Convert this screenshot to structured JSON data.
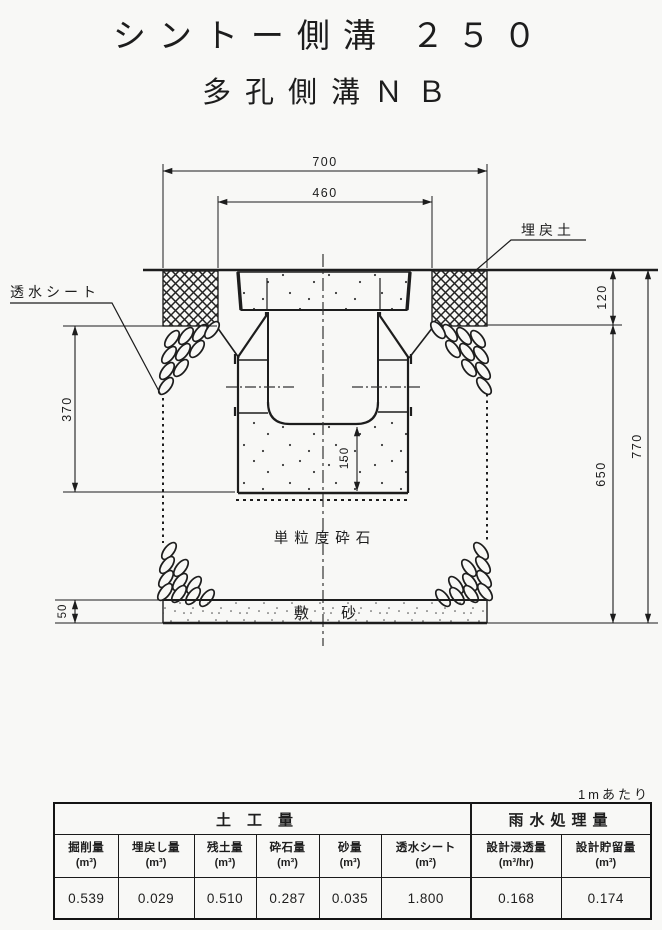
{
  "page": {
    "title": "シントー側溝 ２５０",
    "subtitle": "多孔側溝ＮＢ"
  },
  "drawing": {
    "labels": {
      "backfill_soil": "埋戻土",
      "permeable_sheet": "透水シート",
      "crushed_stone": "単粒度砕石",
      "bedding_sand": "敷 砂"
    },
    "dimensions": {
      "top_width": "700",
      "opening_width": "460",
      "backfill_depth": "120",
      "side_depth": "370",
      "invert_height": "150",
      "lower_depth": "650",
      "total_depth": "770",
      "sand_thickness": "50"
    }
  },
  "table": {
    "note": "1mあたり",
    "group_headers": [
      {
        "label": "土工量",
        "colspan": 6
      },
      {
        "label": "雨水処理量",
        "colspan": 2
      }
    ],
    "columns": [
      {
        "name": "掘削量",
        "unit": "(m³)",
        "value": "0.539"
      },
      {
        "name": "埋戻し量",
        "unit": "(m³)",
        "value": "0.029"
      },
      {
        "name": "残土量",
        "unit": "(m³)",
        "value": "0.510"
      },
      {
        "name": "砕石量",
        "unit": "(m³)",
        "value": "0.287"
      },
      {
        "name": "砂量",
        "unit": "(m³)",
        "value": "0.035"
      },
      {
        "name": "透水シート",
        "unit": "(m²)",
        "value": "1.800"
      },
      {
        "name": "設計浸透量",
        "unit": "(m³/hr)",
        "value": "0.168"
      },
      {
        "name": "設計貯留量",
        "unit": "(m³)",
        "value": "0.174"
      }
    ]
  },
  "colors": {
    "ink": "#1d1d1d",
    "paper": "#f8f8f6"
  }
}
